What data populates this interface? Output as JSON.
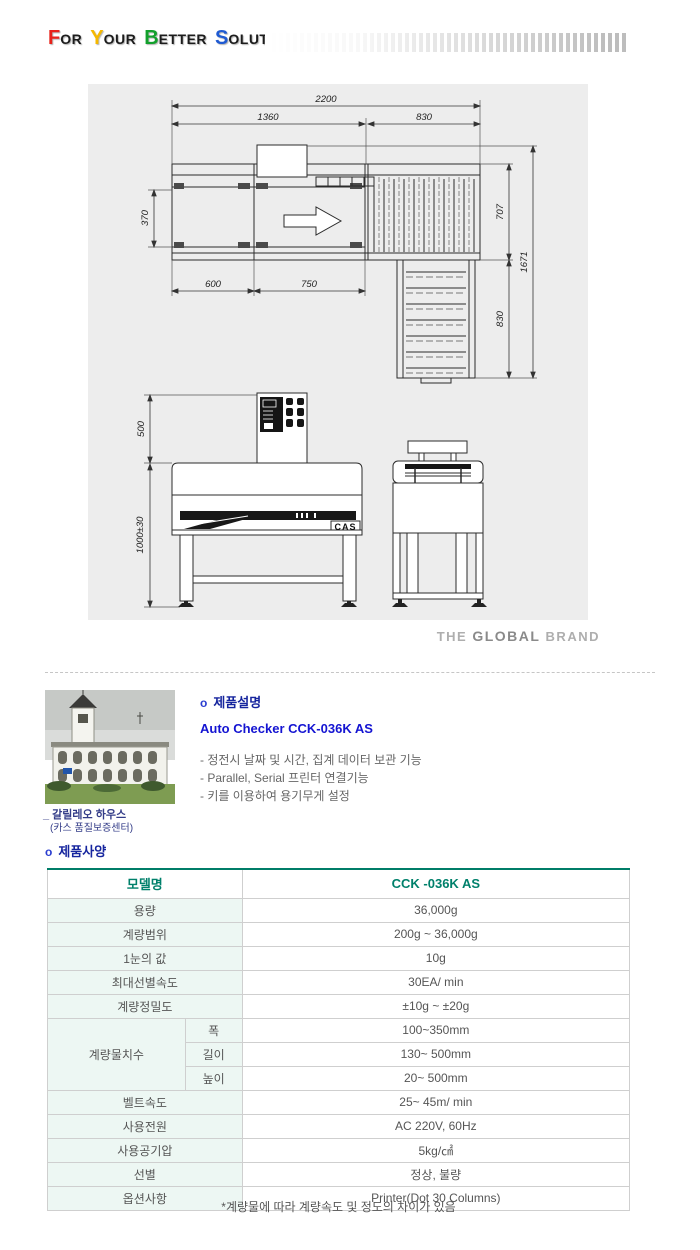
{
  "header": {
    "title_parts": [
      {
        "t": "F"
      },
      {
        "t": "OR"
      },
      {
        "t": "Y"
      },
      {
        "t": "OUR"
      },
      {
        "t": "B"
      },
      {
        "t": "ETTER"
      },
      {
        "t": "S"
      },
      {
        "t": "OLUTION"
      }
    ]
  },
  "colors": {
    "letter_f": "#e8221a",
    "letter_y": "#f5b800",
    "letter_b": "#12a02c",
    "letter_s": "#1f5ad2",
    "table_accent": "#007d68",
    "table_header_text": "#00806b",
    "table_label_bg": "#edf7f3",
    "heading_navy": "#16259e",
    "model_blue": "#1414d2",
    "drawing_bg": "#ededed"
  },
  "drawing": {
    "top_view": {
      "dims": {
        "total_width": "2200",
        "left_section": "1360",
        "right_section": "830",
        "belt_width": "370",
        "right_depth": "707",
        "total_depth": "1671",
        "infeed_length": "600",
        "weigh_length": "750",
        "reject_length": "830"
      }
    },
    "front_view": {
      "dims": {
        "panel_height": "500",
        "work_height": "1000±30"
      },
      "logo": "CAS"
    }
  },
  "brand_line": {
    "the": "THE",
    "global": "GLOBAL",
    "brand": "BRAND"
  },
  "product": {
    "bullet": "o",
    "section_title": "제품설명",
    "model_title": "Auto Checker CCK-036K AS",
    "features": [
      "- 정전시 날짜 및 시간, 집계 데이터 보관 기능",
      "- Parallel, Serial 프린터 연결기능",
      "- 키를 이용하여 용기무게 설정"
    ],
    "photo_caption_line1": "_ 갈릴레오 하우스",
    "photo_caption_line2": "(카스 품질보증센터)"
  },
  "spec": {
    "section_title": "제품사양",
    "table": {
      "model_label": "모델명",
      "model_value": "CCK -036K AS",
      "rows_before": [
        {
          "label": "용량",
          "value": "36,000g"
        },
        {
          "label": "계량범위",
          "value": "200g ~ 36,000g"
        },
        {
          "label": "1눈의 값",
          "value": "10g"
        },
        {
          "label": "최대선별속도",
          "value": "30EA/ min"
        },
        {
          "label": "계량정밀도",
          "value": "±10g ~ ±20g"
        }
      ],
      "size_group": {
        "label": "계량물치수",
        "subrows": [
          {
            "label": "폭",
            "value": "100~350mm"
          },
          {
            "label": "길이",
            "value": "130~ 500mm"
          },
          {
            "label": "높이",
            "value": "20~ 500mm"
          }
        ]
      },
      "rows_after": [
        {
          "label": "벨트속도",
          "value": "25~ 45m/ min"
        },
        {
          "label": "사용전원",
          "value": "AC 220V, 60Hz"
        },
        {
          "label": "사용공기압",
          "value": "5kg/㎠"
        },
        {
          "label": "선별",
          "value": "정상, 불량"
        },
        {
          "label": "옵션사항",
          "value": "Printer(Dot 30 Columns)"
        }
      ]
    },
    "footnote": "*계량물에 따라 계량속도 및 정도의 차이가 있음"
  }
}
